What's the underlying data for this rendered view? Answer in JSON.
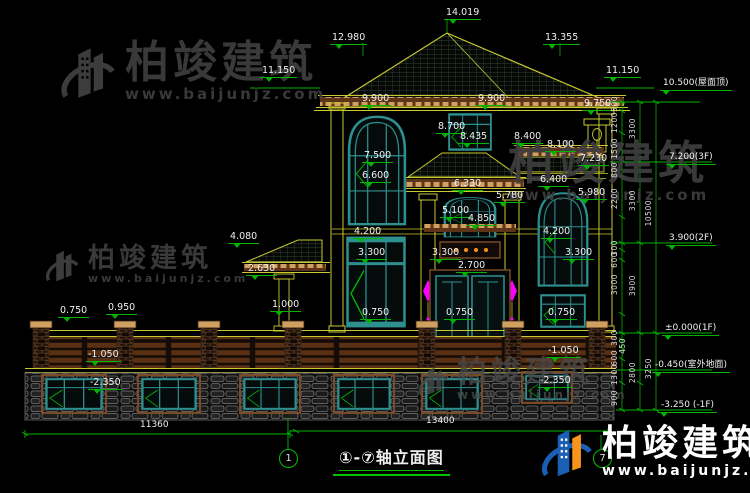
{
  "drawing": {
    "title": "①-⑦轴立面图",
    "axis_left": "1",
    "axis_right": "7"
  },
  "watermark": {
    "brand": "柏竣建筑",
    "site": "www.baijunjz.com"
  },
  "colors": {
    "background": "#000000",
    "dimension_green": "#00b400",
    "line_yellow": "#c9c930",
    "window_teal": "#2e8f8f",
    "band_brown": "#6b3a1b",
    "dentil_tan": "#cfa060",
    "lamp_magenta": "#ff00ff",
    "watermark_gray": "#3e3e3e",
    "brand_blue": "#1a5fb4",
    "brand_orange": "#f7941d",
    "text_white": "#f0f0f0"
  },
  "annotations": {
    "dims": [
      {
        "t": "14.019",
        "x": 444,
        "y": 8
      },
      {
        "t": "12.980",
        "x": 330,
        "y": 33
      },
      {
        "t": "13.355",
        "x": 543,
        "y": 33
      },
      {
        "t": "11.150",
        "x": 260,
        "y": 66
      },
      {
        "t": "11.150",
        "x": 604,
        "y": 66
      },
      {
        "t": "9.900",
        "x": 360,
        "y": 94
      },
      {
        "t": "9.900",
        "x": 476,
        "y": 94
      },
      {
        "t": "9.750",
        "x": 582,
        "y": 99
      },
      {
        "t": "8.700",
        "x": 436,
        "y": 122
      },
      {
        "t": "8.435",
        "x": 458,
        "y": 132
      },
      {
        "t": "8.400",
        "x": 512,
        "y": 132
      },
      {
        "t": "8.100",
        "x": 545,
        "y": 140
      },
      {
        "t": "7.500",
        "x": 362,
        "y": 151
      },
      {
        "t": "7.230",
        "x": 578,
        "y": 154
      },
      {
        "t": "6.600",
        "x": 360,
        "y": 171
      },
      {
        "t": "6.330",
        "x": 452,
        "y": 179
      },
      {
        "t": "6.400",
        "x": 538,
        "y": 175
      },
      {
        "t": "5.980",
        "x": 576,
        "y": 188
      },
      {
        "t": "5.780",
        "x": 494,
        "y": 191
      },
      {
        "t": "5.100",
        "x": 440,
        "y": 206
      },
      {
        "t": "4.850",
        "x": 466,
        "y": 214
      },
      {
        "t": "4.200",
        "x": 352,
        "y": 227
      },
      {
        "t": "4.200",
        "x": 541,
        "y": 227
      },
      {
        "t": "4.080",
        "x": 228,
        "y": 232
      },
      {
        "t": "3.300",
        "x": 356,
        "y": 248
      },
      {
        "t": "3.300",
        "x": 430,
        "y": 248
      },
      {
        "t": "3.300",
        "x": 563,
        "y": 248
      },
      {
        "t": "2.700",
        "x": 456,
        "y": 261
      },
      {
        "t": "2.630",
        "x": 246,
        "y": 264
      },
      {
        "t": "1.000",
        "x": 270,
        "y": 300
      },
      {
        "t": "0.750",
        "x": 58,
        "y": 306
      },
      {
        "t": "0.950",
        "x": 106,
        "y": 303
      },
      {
        "t": "0.750",
        "x": 360,
        "y": 308
      },
      {
        "t": "0.750",
        "x": 444,
        "y": 308
      },
      {
        "t": "0.750",
        "x": 546,
        "y": 308
      },
      {
        "t": "-1.050",
        "x": 86,
        "y": 350
      },
      {
        "t": "-1.050",
        "x": 546,
        "y": 346
      },
      {
        "t": "-2.350",
        "x": 88,
        "y": 378
      },
      {
        "t": "-2.350",
        "x": 538,
        "y": 376
      }
    ],
    "levels": [
      {
        "t": "10.500(屋面顶)",
        "x": 660,
        "y": 79
      },
      {
        "t": "7.200(3F)",
        "x": 666,
        "y": 153
      },
      {
        "t": "3.900(2F)",
        "x": 666,
        "y": 234
      },
      {
        "t": "±0.000(1F)",
        "x": 662,
        "y": 324
      },
      {
        "t": "-0.450(室外地面)",
        "x": 652,
        "y": 361
      },
      {
        "t": "-3.250 (-1F)",
        "x": 658,
        "y": 401
      }
    ],
    "plain": [
      {
        "t": "11360",
        "x": 140,
        "y": 421
      },
      {
        "t": "13400",
        "x": 426,
        "y": 417
      }
    ],
    "chain": [
      {
        "t": "500",
        "x": 611,
        "y": 96
      },
      {
        "t": "1200",
        "x": 611,
        "y": 112
      },
      {
        "t": "3300",
        "x": 629,
        "y": 118
      },
      {
        "t": "1500",
        "x": 611,
        "y": 138
      },
      {
        "t": "800",
        "x": 611,
        "y": 162
      },
      {
        "t": "2200",
        "x": 611,
        "y": 188
      },
      {
        "t": "3300",
        "x": 629,
        "y": 190
      },
      {
        "t": "10500",
        "x": 645,
        "y": 200
      },
      {
        "t": "300",
        "x": 611,
        "y": 240
      },
      {
        "t": "600",
        "x": 611,
        "y": 252
      },
      {
        "t": "3000",
        "x": 611,
        "y": 274
      },
      {
        "t": "3900",
        "x": 629,
        "y": 275
      },
      {
        "t": "300",
        "x": 611,
        "y": 330
      },
      {
        "t": "450",
        "x": 619,
        "y": 338
      },
      {
        "t": "600",
        "x": 611,
        "y": 350
      },
      {
        "t": "1300",
        "x": 611,
        "y": 364
      },
      {
        "t": "2800",
        "x": 629,
        "y": 362
      },
      {
        "t": "3250",
        "x": 645,
        "y": 358
      },
      {
        "t": "900",
        "x": 611,
        "y": 390
      }
    ]
  }
}
